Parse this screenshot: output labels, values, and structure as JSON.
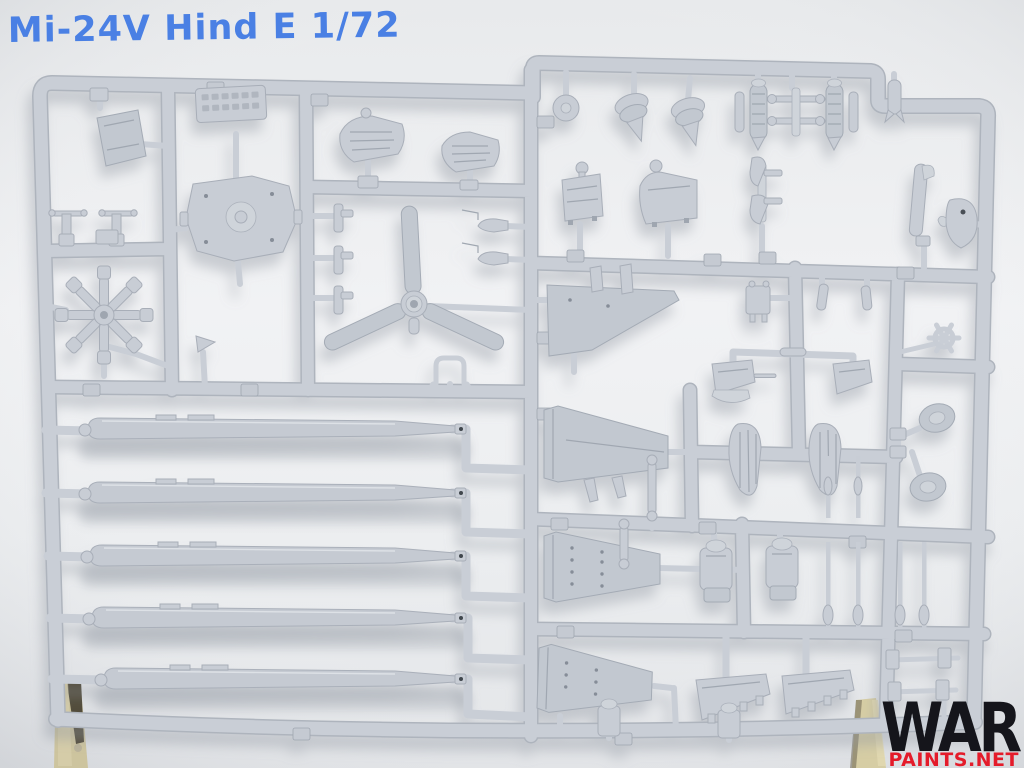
{
  "photo": {
    "handwritten_title": "Mi-24V Hind E 1/72",
    "watermark": {
      "line1": "WAR",
      "line2": "PAINTS.NET"
    },
    "colors": {
      "background": "#eef0f2",
      "plastic": "#c9ced6",
      "plastic_shadow": "#aeb4bd",
      "title_ink": "#4a80e4",
      "watermark_primary": "#15151b",
      "watermark_secondary": "#e41b2a",
      "wood_support": "#d2c9a0"
    }
  }
}
